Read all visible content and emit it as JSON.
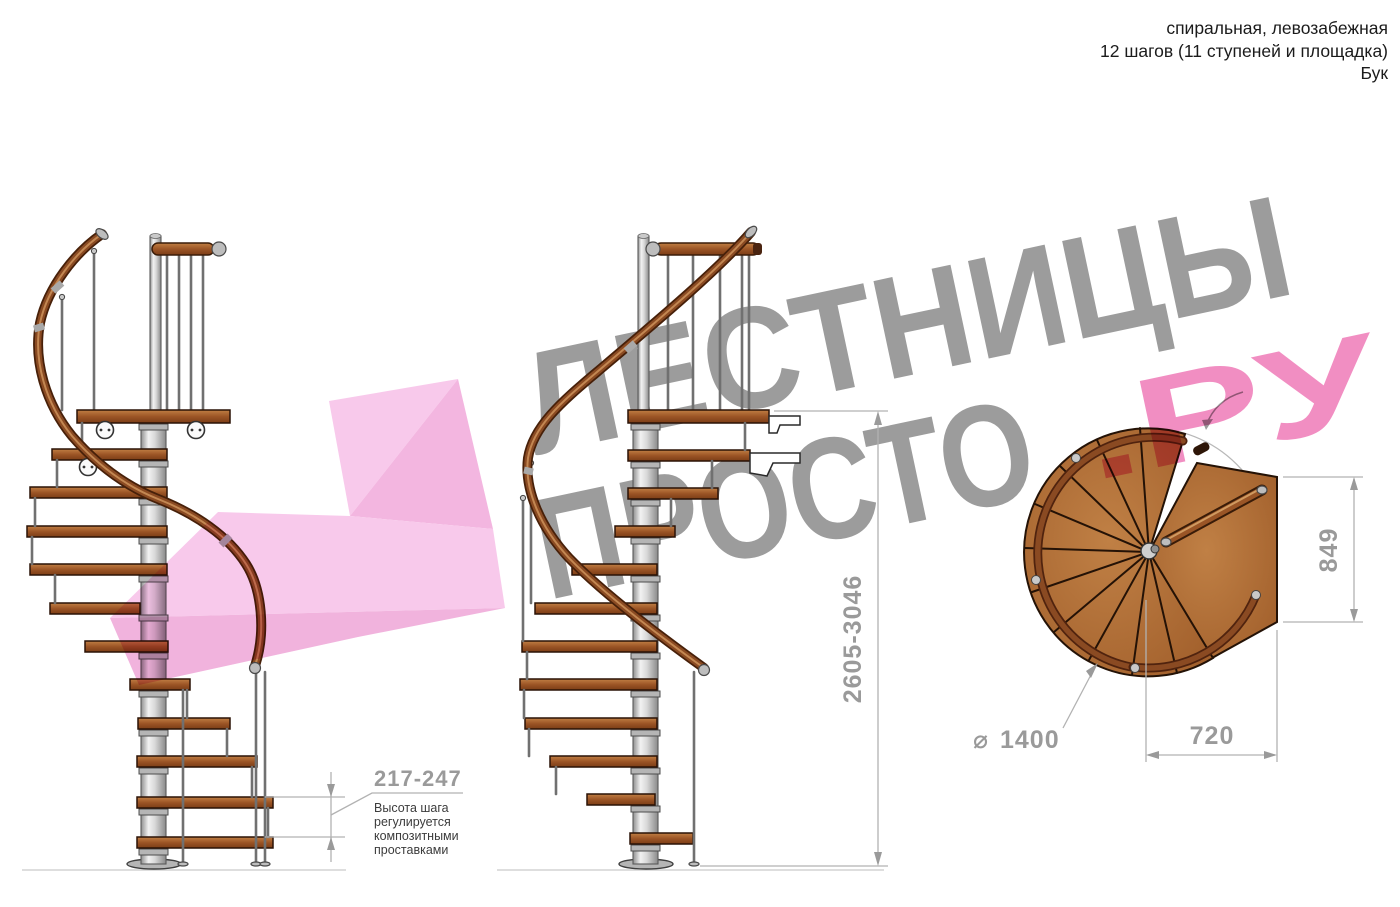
{
  "header": {
    "line1": "спиральная, левозабежная",
    "line2": "12 шагов (11 ступеней и площадка)",
    "line3": "Бук"
  },
  "watermark": {
    "brand_line1": "ЛЕСТНИЦЫ",
    "brand_line2": "ПРОСТО",
    "brand_suffix": ".РУ"
  },
  "dimensions": {
    "step_height": {
      "value": "217-247",
      "note_lines": [
        "Высота шага",
        "регулируется",
        "композитными",
        "проставками"
      ]
    },
    "total_height": "2605-3046",
    "landing_depth": "849",
    "landing_width": "720",
    "diameter_symbol": "⌀",
    "diameter_value": "1400"
  },
  "colors": {
    "wood": "#a2602c",
    "metal": "#d9d9d9",
    "watermark_gray": "#9c9c9c",
    "watermark_pink": "#ef7ab7",
    "dimension_gray": "#9a9a9a",
    "arrow_pink_light": "#f7bde7",
    "arrow_pink_mid": "#f1a6d9"
  }
}
